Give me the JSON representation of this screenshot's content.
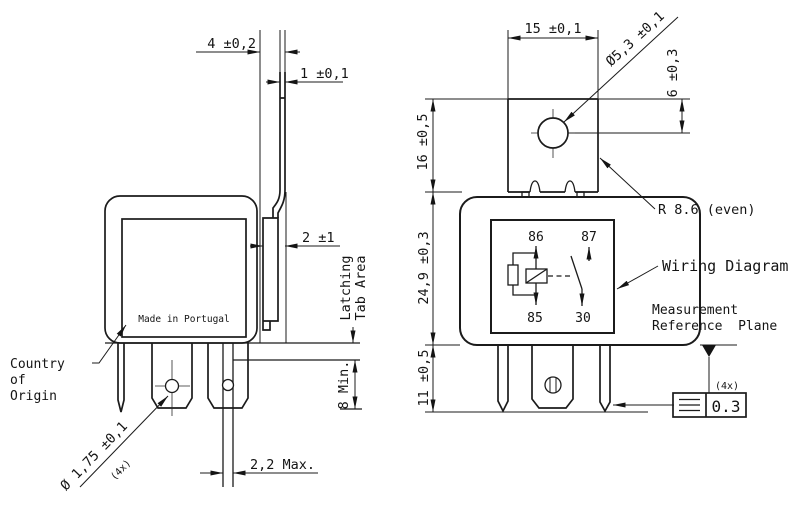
{
  "colors": {
    "line": "#1b1b1b",
    "background": "#ffffff"
  },
  "left_view": {
    "marking": "Made in Portugal",
    "callout": {
      "line1": "Country",
      "line2": "of",
      "line3": "Origin"
    },
    "dims": {
      "bracket_offset": "4 ±0,2",
      "bracket_thickness": "1 ±0,1",
      "latch_thickness": "2 ±1",
      "latch_area_line1": "Latching",
      "latch_area_line2": "Tab Area",
      "pin_free_length": "8 Min.",
      "terminal_thickness": "2,2 Max.",
      "terminal_hole_dia": "Ø 1,75 ±0,1",
      "terminal_hole_qty": "(4x)"
    }
  },
  "right_view": {
    "dims": {
      "bracket_width": "15 ±0,1",
      "bracket_hole_dia": "Ø5,3 ±0,1",
      "hole_center_offset": "6 ±0,3",
      "bracket_height": "16 ±0,5",
      "body_height": "24,9 ±0,3",
      "terminal_height": "11 ±0,5",
      "corner_radius": "R 8.6 (even)"
    },
    "wiring_diagram": {
      "label": "Wiring Diagram",
      "terminal_86": "86",
      "terminal_87": "87",
      "terminal_85": "85",
      "terminal_30": "30"
    },
    "datum": {
      "label_line1": "Measurement",
      "label_line2": "Reference  Plane",
      "qty": "(4x)",
      "tolerance": "0.3"
    }
  }
}
